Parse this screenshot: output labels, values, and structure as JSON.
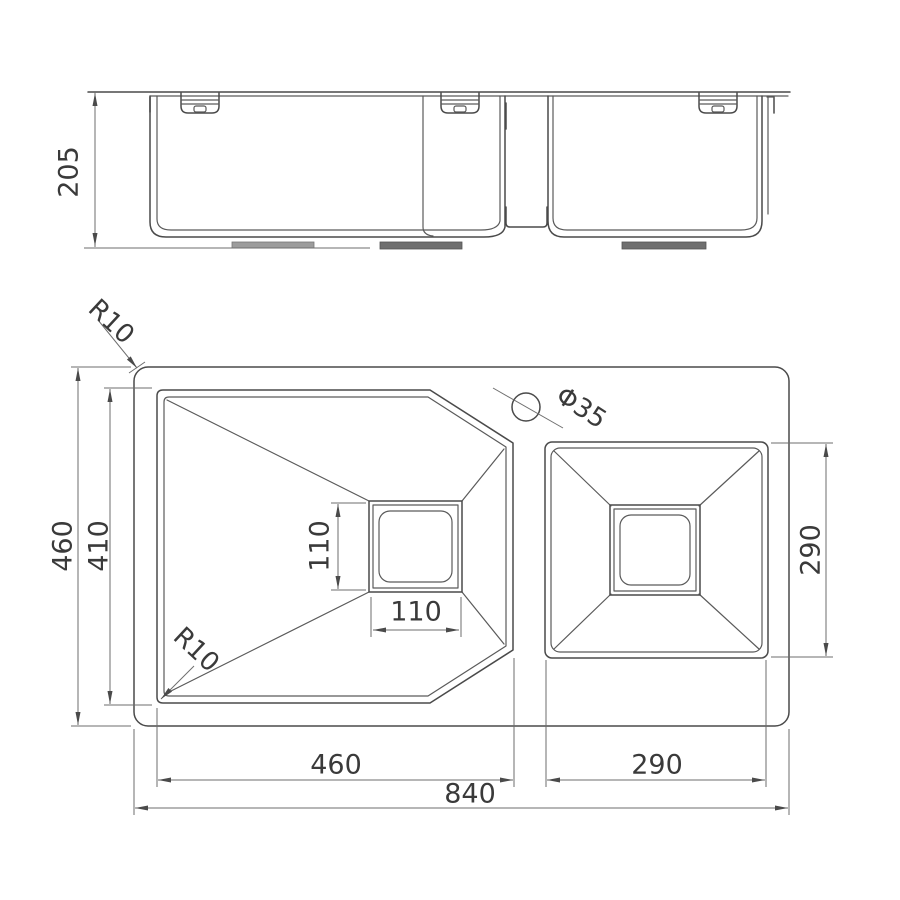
{
  "drawing": {
    "title": "double bowl undermount sink technical drawing",
    "background_color": "#ffffff",
    "line_color": "#4a4a4a",
    "dim_line_color": "#6e6e6e",
    "text_color": "#3a3a3a",
    "pad_color": "#6f6f6f"
  },
  "dimensions": {
    "side_view": {
      "height": "205"
    },
    "plan_view": {
      "overall_width": "840",
      "overall_depth": "460",
      "main_bowl_width": "460",
      "main_bowl_depth": "410",
      "second_bowl_width": "290",
      "second_bowl_depth": "290",
      "main_drain_width": "110",
      "main_drain_depth": "110",
      "outer_corner_radius": "R10",
      "bowl_corner_radius": "R10",
      "faucet_hole_diameter": "Φ35"
    }
  }
}
